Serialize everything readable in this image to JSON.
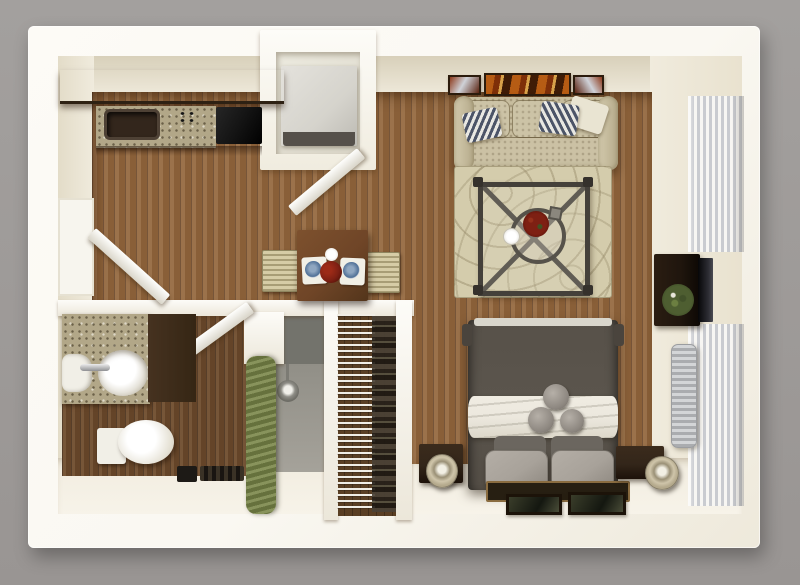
{
  "meta": {
    "kind": "3d-floor-plan-render",
    "view": "top-down",
    "unit_type": "studio-apartment"
  },
  "palette": {
    "bg_gray": "#a3a09e",
    "bg_gray2": "#999593",
    "wall": "#faf8f2",
    "wall_edge": "#e6e1d2",
    "face_top": "#d8d0ba",
    "face_light": "#f0ebdd",
    "face_right": "#e9e2cf",
    "face_bottom": "#f1ecdf",
    "wood": "#93663c",
    "wood_dark": "#6e4b2c",
    "wood_closet": "#5a3f24",
    "cabinet": "#46331f",
    "granite": "#b2a788",
    "stove": "#141414",
    "sink_dark": "#33261c",
    "sofa": "#c7bd9e",
    "rug": "#d4ccac",
    "pillow_navy": "#4c5468",
    "table_wood": "#6f4527",
    "chair": "#cfc5a0",
    "coffee_frame": "#44403a",
    "flower_red": "#7e2013",
    "bed": "#5b554d",
    "sheet": "#ece8de",
    "pillow_light": "#a8a29a",
    "pillow_dark": "#6b665f",
    "bed_rug": "#271f12",
    "rug_border": "#8a6c40",
    "nightstand": "#33261a",
    "lamp": "#cfc5aa",
    "curtain": "#6f7b45",
    "shower_floor": "#a5a29a",
    "shower_tile": "#73736c",
    "porcelain": "#f1efe7",
    "radiator": "#c3c5c7",
    "blind_light": "#f7f6f3",
    "blind_dark": "#c9cbd0",
    "tv_cabinet": "#1f150d",
    "plant": "#4e5e31",
    "art_orange": "#b65c14",
    "frame_dark": "#2c1c0d",
    "appliance": "#d5d3cc"
  },
  "rooms": [
    {
      "name": "kitchen",
      "furniture": [
        "upper-cabinets",
        "granite-counter",
        "kitchen-sink",
        "stove",
        "entry-door"
      ]
    },
    {
      "name": "utility-closet",
      "furniture": [
        "appliance-unit",
        "utility-door"
      ]
    },
    {
      "name": "dining-area",
      "furniture": [
        "dining-table",
        "dining-chair-left",
        "dining-chair-right",
        "placemats",
        "plates",
        "flower-centerpiece"
      ]
    },
    {
      "name": "living-room",
      "furniture": [
        "wall-art-triptych",
        "sofa",
        "throw-pillows",
        "area-rug",
        "coffee-table",
        "flower-bowl",
        "tv-cabinet",
        "television",
        "plant"
      ]
    },
    {
      "name": "bathroom",
      "furniture": [
        "granite-vanity",
        "white-sink",
        "faucet",
        "toilet",
        "shower",
        "shower-curtain",
        "bathroom-door",
        "floor-mat"
      ]
    },
    {
      "name": "walk-in-closet",
      "furniture": [
        "wire-shelving",
        "hanging-clothes"
      ]
    },
    {
      "name": "bedroom",
      "furniture": [
        "bed",
        "white-sheet-band",
        "round-accent-pillows",
        "bed-pillows",
        "foot-rug",
        "picture-frames",
        "nightstand-left",
        "nightstand-right",
        "lamp-left",
        "lamp-right",
        "radiator"
      ]
    },
    {
      "name": "windows",
      "furniture": [
        "vertical-blinds-top",
        "vertical-blinds-bottom"
      ]
    }
  ]
}
